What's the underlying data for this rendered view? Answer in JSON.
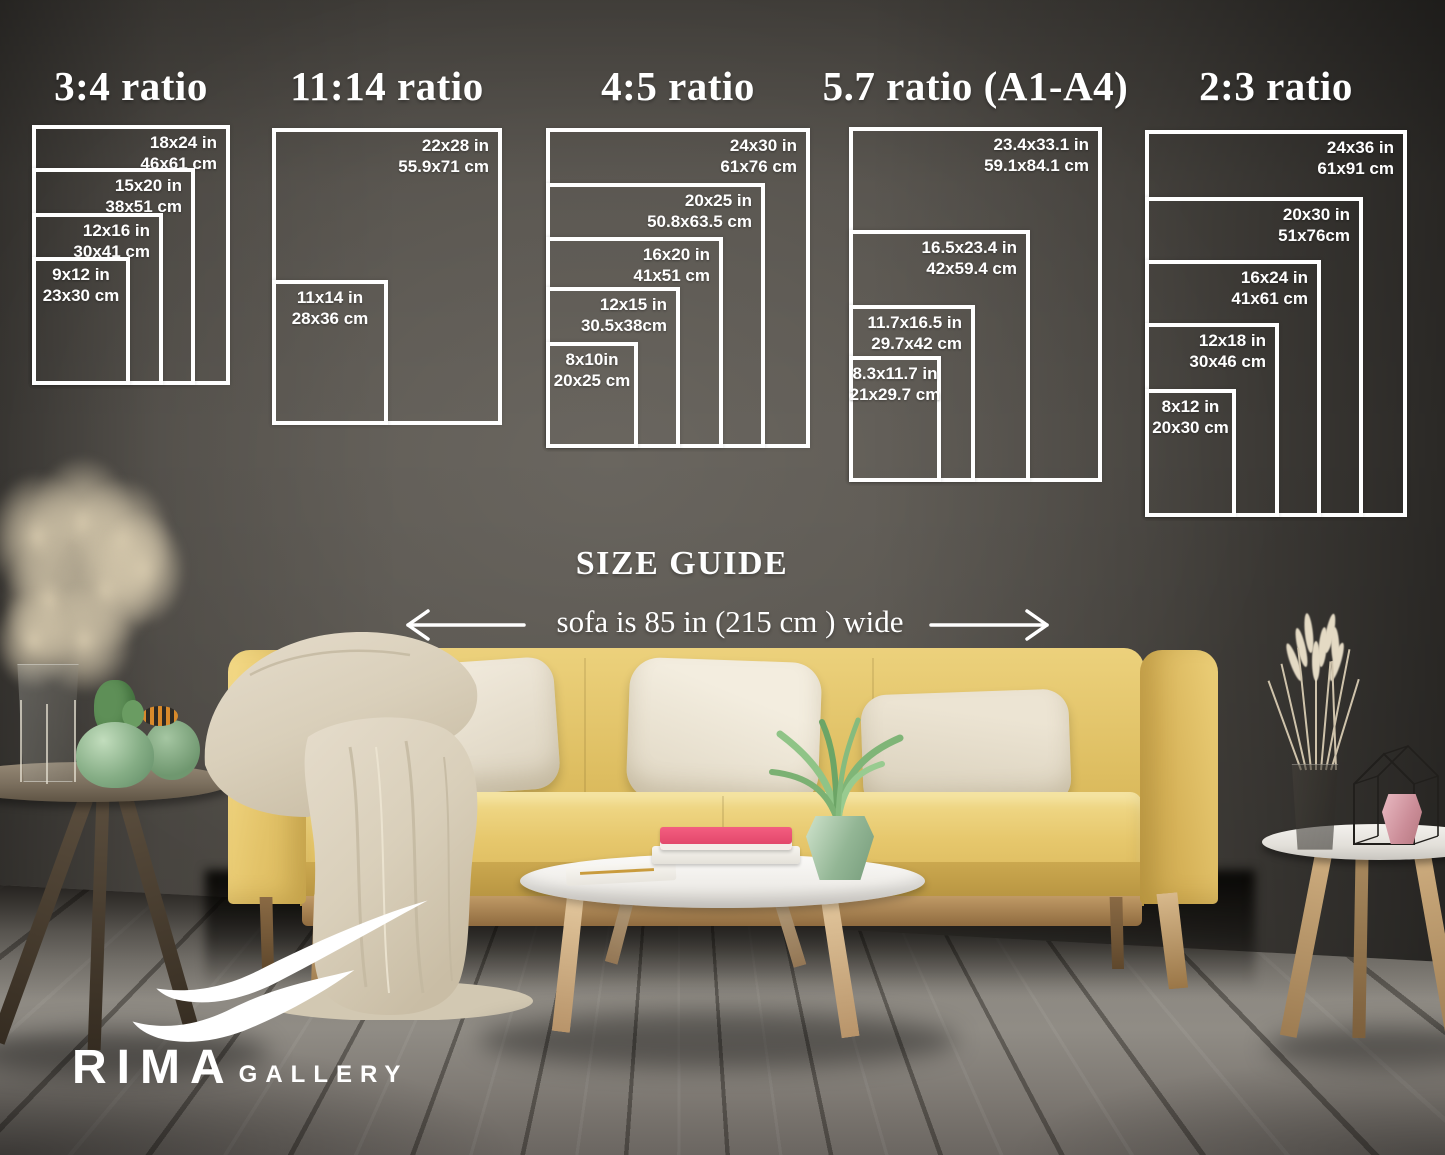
{
  "colors": {
    "wall": "#57534d",
    "floor": "#85817a",
    "line_white": "#ffffff",
    "sofa_yellow": "#e3c268",
    "pillow_beige": "#e9e1d1",
    "blanket_beige": "#d9cfba",
    "book_pink": "#e8476b",
    "plant_green": "#85bb7d",
    "table_white": "#f2f0ec"
  },
  "size_guide": {
    "heading": "SIZE GUIDE",
    "sofa_note": "sofa is 85 in (215 cm ) wide",
    "groups": [
      {
        "id": "ratio-3-4",
        "title": "3:4 ratio",
        "sizes": [
          {
            "inches": "18x24 in",
            "cm": "46x61 cm"
          },
          {
            "inches": "15x20 in",
            "cm": "38x51 cm"
          },
          {
            "inches": "12x16 in",
            "cm": "30x41 cm"
          },
          {
            "inches": "9x12 in",
            "cm": "23x30 cm"
          }
        ]
      },
      {
        "id": "ratio-11-14",
        "title": "11:14 ratio",
        "sizes": [
          {
            "inches": "22x28 in",
            "cm": "55.9x71 cm"
          },
          {
            "inches": "11x14 in",
            "cm": "28x36 cm"
          }
        ]
      },
      {
        "id": "ratio-4-5",
        "title": "4:5 ratio",
        "sizes": [
          {
            "inches": "24x30 in",
            "cm": "61x76 cm"
          },
          {
            "inches": "20x25 in",
            "cm": "50.8x63.5 cm"
          },
          {
            "inches": "16x20 in",
            "cm": "41x51 cm"
          },
          {
            "inches": "12x15 in",
            "cm": "30.5x38cm"
          },
          {
            "inches": "8x10in",
            "cm": "20x25 cm"
          }
        ]
      },
      {
        "id": "ratio-5-7",
        "title": "5.7 ratio (A1-A4)",
        "sizes": [
          {
            "inches": "23.4x33.1 in",
            "cm": "59.1x84.1 cm"
          },
          {
            "inches": "16.5x23.4 in",
            "cm": "42x59.4 cm"
          },
          {
            "inches": "11.7x16.5 in",
            "cm": "29.7x42 cm"
          },
          {
            "inches": "8.3x11.7 in",
            "cm": "21x29.7 cm"
          }
        ]
      },
      {
        "id": "ratio-2-3",
        "title": "2:3 ratio",
        "sizes": [
          {
            "inches": "24x36 in",
            "cm": "61x91 cm"
          },
          {
            "inches": "20x30 in",
            "cm": "51x76cm"
          },
          {
            "inches": "16x24 in",
            "cm": "41x61 cm"
          },
          {
            "inches": "12x18 in",
            "cm": "30x46 cm"
          },
          {
            "inches": "8x12 in",
            "cm": "20x30 cm"
          }
        ]
      }
    ]
  },
  "logo": {
    "brand": "RIMA",
    "suffix": "GALLERY"
  }
}
